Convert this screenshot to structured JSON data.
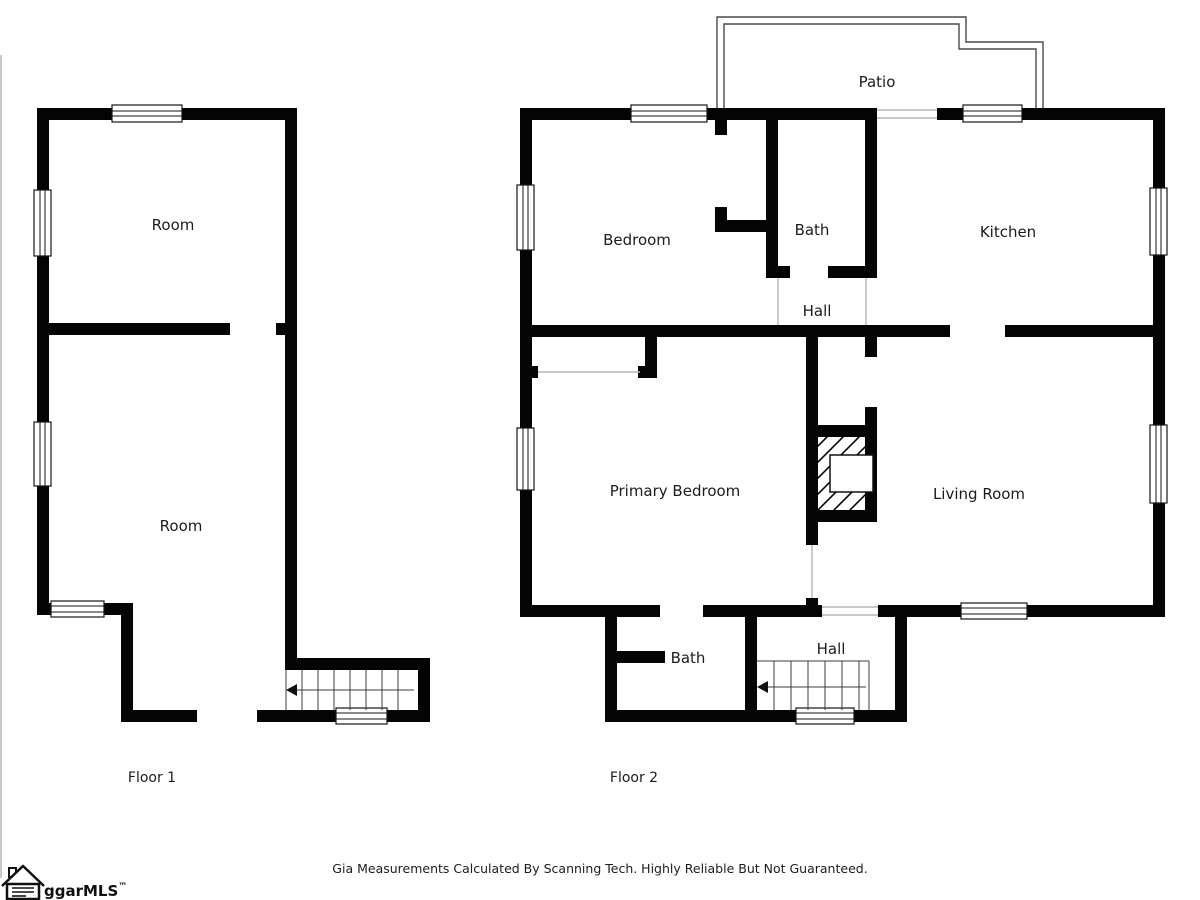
{
  "document": {
    "background": "#ffffff"
  },
  "floor1": {
    "label": "Floor 1",
    "rooms": {
      "room_top": "Room",
      "room_bottom": "Room"
    }
  },
  "floor2": {
    "label": "Floor 2",
    "rooms": {
      "bedroom": "Bedroom",
      "bath_upper": "Bath",
      "kitchen": "Kitchen",
      "hall_upper": "Hall",
      "patio": "Patio",
      "primary_bedroom": "Primary Bedroom",
      "living_room": "Living Room",
      "bath_lower": "Bath",
      "hall_lower": "Hall"
    }
  },
  "footer": {
    "disclaimer": "Gia Measurements Calculated By Scanning Tech. Highly Reliable But Not Guaranteed."
  },
  "logo": {
    "text": "ggarMLS",
    "trademark": "™"
  },
  "colors": {
    "wall": "#000000",
    "label": "#1c1c1c",
    "opening_line": "#b5b5b5",
    "stair_line": "#3d3d3d",
    "patio_line": "#4a4a4a",
    "edge_line": "#c8c8c8"
  }
}
